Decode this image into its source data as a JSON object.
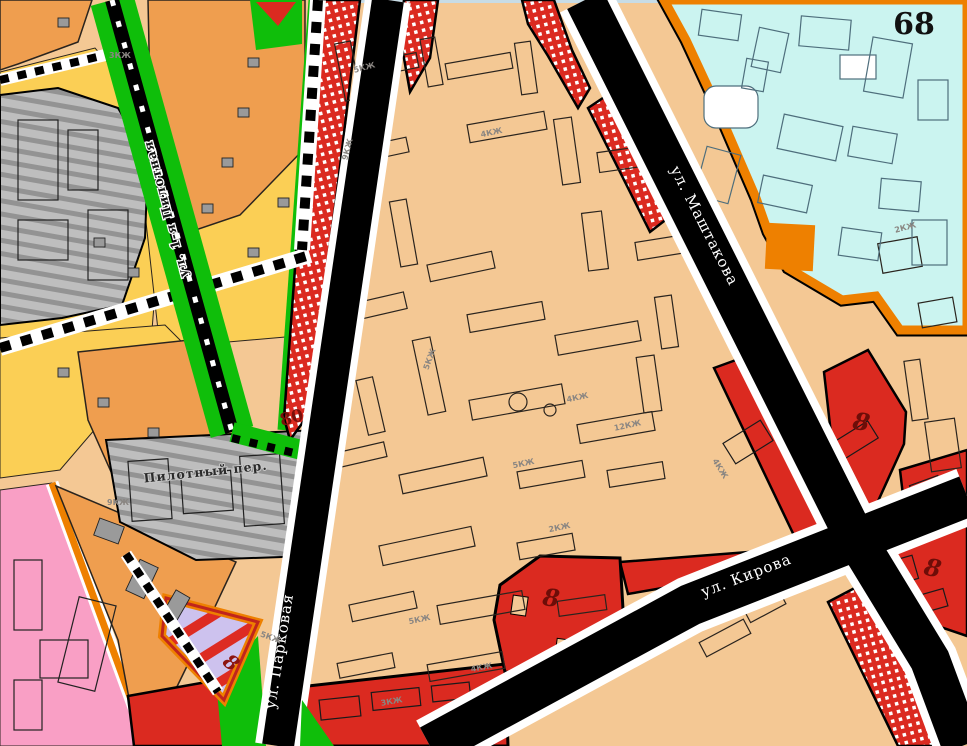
{
  "map": {
    "streets": [
      {
        "name": "ул. Маштакова"
      },
      {
        "name": "ул. Кирова"
      },
      {
        "name": "ул. Парковая"
      },
      {
        "name": "ул. 1-я Пилотная"
      },
      {
        "name": "Пилотный пер."
      }
    ],
    "blocks": [
      {
        "n": "68"
      },
      {
        "n": "80"
      },
      {
        "n": "8"
      },
      {
        "n": "8"
      },
      {
        "n": "8"
      },
      {
        "n": "8"
      }
    ],
    "building_labels": [
      {
        "t": "5КЖ"
      },
      {
        "t": "4КЖ"
      },
      {
        "t": "9КЖ"
      },
      {
        "t": "5КЖ"
      },
      {
        "t": "4КЖ"
      },
      {
        "t": "12КЖ"
      },
      {
        "t": "5КЖ"
      },
      {
        "t": "2КЖ"
      },
      {
        "t": "5КЖ"
      },
      {
        "t": "4КЖ"
      },
      {
        "t": "3КЖ"
      },
      {
        "t": "4КЖ"
      },
      {
        "t": "5КЖ"
      },
      {
        "t": "2КЖ"
      },
      {
        "t": "3КЖ"
      },
      {
        "t": "9КЖ"
      }
    ],
    "colors": {
      "residential_midrise_peach": "#F4C894",
      "residential_orange": "#EF9E4F",
      "individual_housing_yellow": "#FBCF55",
      "public_red": "#DB2A20",
      "special_red_hatched": "#DB2A20",
      "social_cyan": "#CBF4F0",
      "industrial_gray": "#BEBEBE",
      "pink_zone": "#F99FC5",
      "lavender_zone": "#CDC2EE",
      "greenery": "#0FBE0A",
      "zone_border_orange": "#EE8000",
      "road_black": "#000000",
      "block_number_darkred": "#7A100B"
    }
  }
}
